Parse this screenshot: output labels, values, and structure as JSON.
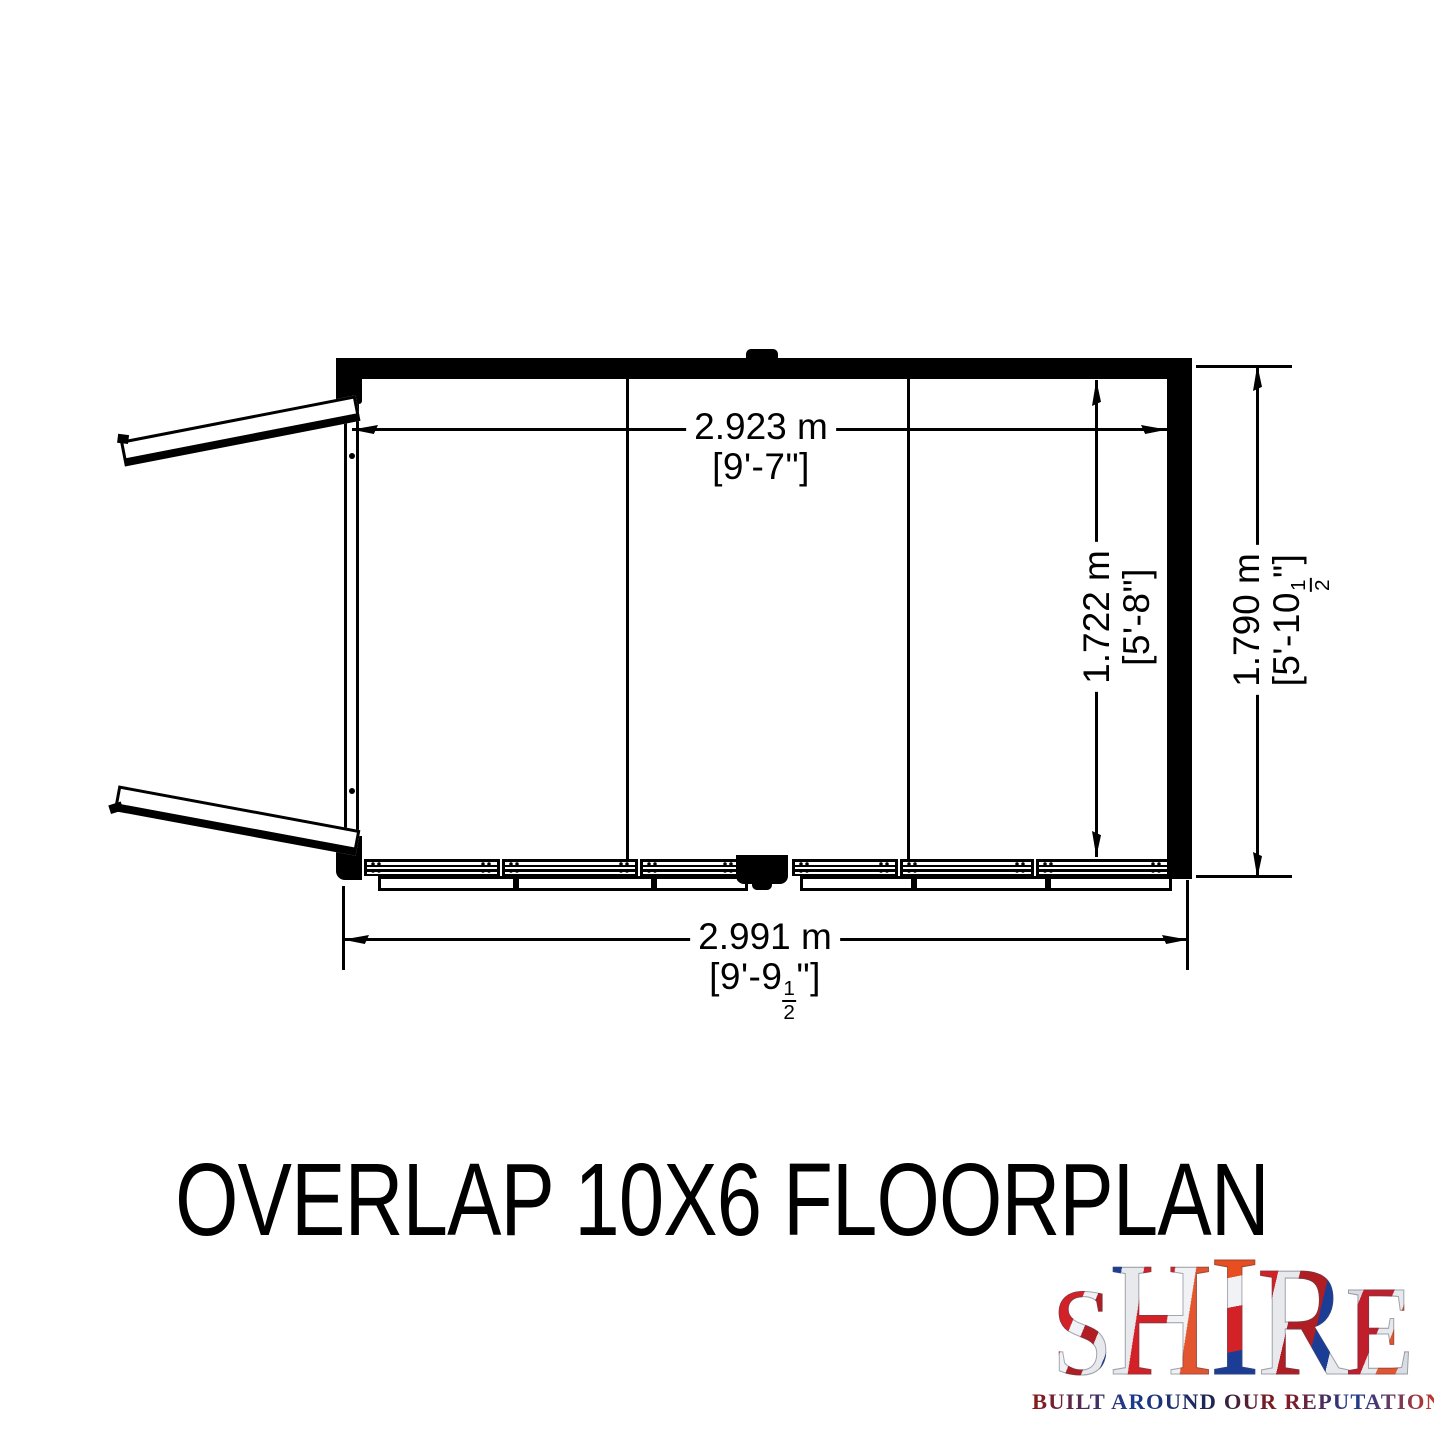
{
  "title": "OVERLAP 10X6 FLOORPLAN",
  "colors": {
    "line": "#000000",
    "background": "#ffffff"
  },
  "floorplan": {
    "dimensions": {
      "interior_width": {
        "metric": "2.923 m",
        "imperial": "[9'-7\"]"
      },
      "interior_depth": {
        "metric": "1.722 m",
        "imperial": "[5'-8\"]"
      },
      "exterior_depth": {
        "metric": "1.790 m",
        "imperial_pre": "[5'-10",
        "frac_num": "1",
        "frac_den": "2",
        "imperial_post": "\"]"
      },
      "exterior_width": {
        "metric": "2.991 m",
        "imperial_pre": "[9'-9",
        "frac_num": "1",
        "frac_den": "2",
        "imperial_post": "\"]"
      }
    }
  },
  "logo": {
    "letters": [
      "S",
      "H",
      "I",
      "R",
      "E"
    ],
    "tagline": "BUILT AROUND OUR REPUTATION",
    "colors": {
      "red": "#d22227",
      "blue": "#1c3d96",
      "silver": "#dfe3e8",
      "orange": "#e8551d"
    }
  }
}
